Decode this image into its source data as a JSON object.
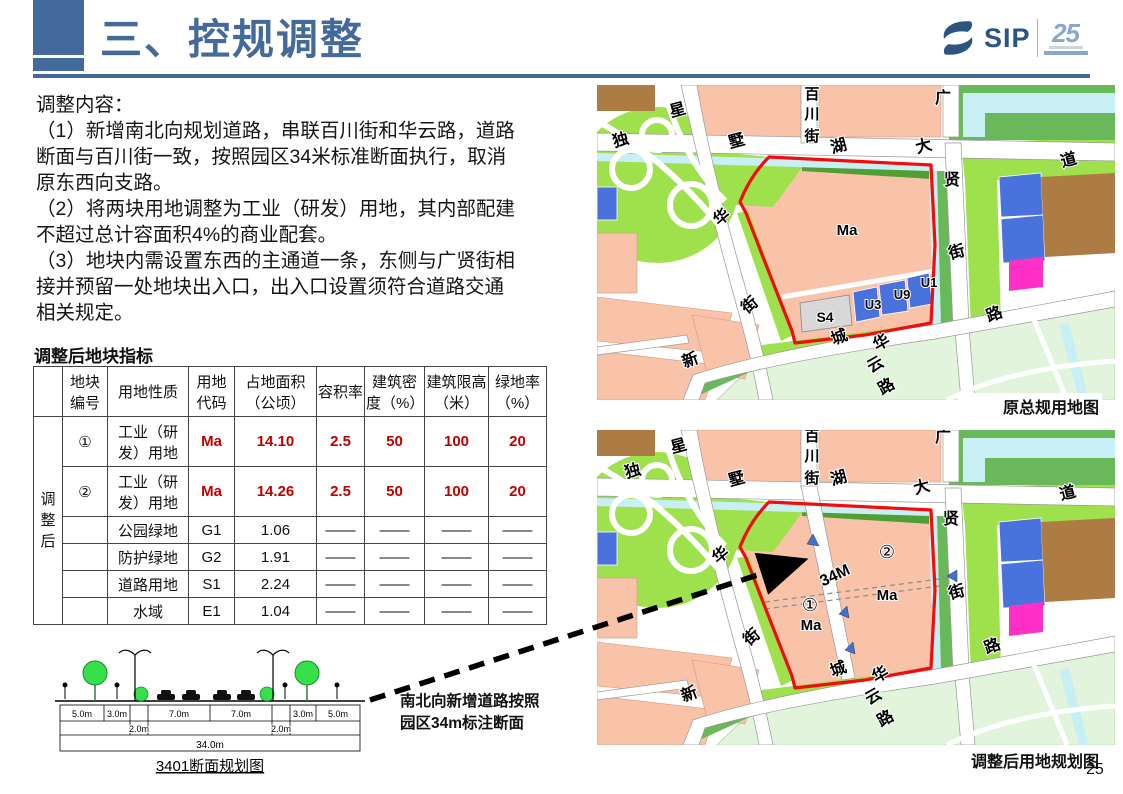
{
  "colors": {
    "accent": "#44699B",
    "table_red": "#C00000",
    "boundary_red": "#F20D0D",
    "salmon": "#F9C3AA",
    "bright_green": "#9FE14D",
    "mid_green": "#69B85A",
    "dark_green": "#4F9F35",
    "pale_green": "#E3F4DC",
    "water": "#C8F0F4",
    "parcel_blue": "#4A72DC",
    "magenta": "#FF2FC8",
    "brown": "#AC7C44",
    "gray_parcel": "#D8D8D8",
    "road_edge": "#999999"
  },
  "page": {
    "number": "25"
  },
  "header": {
    "title": "三、控规调整",
    "logo_text": "SIP",
    "logo_badge": "25"
  },
  "content": {
    "lines": [
      "调整内容：",
      "（1）新增南北向规划道路，串联百川街和华云路，道路",
      "断面与百川街一致，按照园区34米标准断面执行，取消",
      "原东西向支路。",
      "（2）将两块用地调整为工业（研发）用地，其内部配建",
      "不超过总计容面积4%的商业配套。",
      "（3）地块内需设置东西的主通道一条，东侧与广贤街相",
      "接并预留一处地块出入口，出入口设置须符合道路交通",
      "相关规定。"
    ]
  },
  "table": {
    "title": "调整后地块指标",
    "group_label": "调整后",
    "headers": [
      "",
      "地块编号",
      "用地性质",
      "用地代码",
      "占地面积（公顷）",
      "容积率",
      "建筑密度（%）",
      "建筑限高（米）",
      "绿地率（%）"
    ],
    "rows": [
      [
        "①",
        "工业（研发）用地",
        "Ma",
        "14.10",
        "2.5",
        "50",
        "100",
        "20"
      ],
      [
        "②",
        "工业（研发）用地",
        "Ma",
        "14.26",
        "2.5",
        "50",
        "100",
        "20"
      ],
      [
        "",
        "公园绿地",
        "G1",
        "1.06",
        "——",
        "——",
        "——",
        "——"
      ],
      [
        "",
        "防护绿地",
        "G2",
        "1.91",
        "——",
        "——",
        "——",
        "——"
      ],
      [
        "",
        "道路用地",
        "S1",
        "2.24",
        "——",
        "——",
        "——",
        "——"
      ],
      [
        "",
        "水域",
        "E1",
        "1.04",
        "——",
        "——",
        "——",
        "——"
      ]
    ]
  },
  "diagram": {
    "caption": "3401断面规划图",
    "labels": [
      {
        "t": "5.0m",
        "x": 37,
        "y": 74,
        "s": 9
      },
      {
        "t": "3.0m",
        "x": 72,
        "y": 74,
        "s": 9
      },
      {
        "t": "7.0m",
        "x": 134,
        "y": 74,
        "s": 9
      },
      {
        "t": "7.0m",
        "x": 196,
        "y": 74,
        "s": 9
      },
      {
        "t": "3.0m",
        "x": 258,
        "y": 74,
        "s": 9
      },
      {
        "t": "5.0m",
        "x": 293,
        "y": 74,
        "s": 9
      },
      {
        "t": "2.0m",
        "x": 94,
        "y": 89,
        "s": 9
      },
      {
        "t": "2.0m",
        "x": 236,
        "y": 89,
        "s": 9
      },
      {
        "t": "34.0m",
        "x": 165,
        "y": 105,
        "s": 10
      }
    ]
  },
  "arrow_note": {
    "lines": [
      "南北向新增道路按照",
      "园区34m标注断面"
    ]
  },
  "maps": {
    "top": {
      "caption": "原总规用地图",
      "labels": [
        {
          "t": "星",
          "x": 82,
          "y": 30,
          "s": 16,
          "b": 1,
          "r": -15
        },
        {
          "t": "独",
          "x": 25,
          "y": 60,
          "s": 16,
          "b": 1,
          "r": -15
        },
        {
          "t": "墅",
          "x": 141,
          "y": 61,
          "s": 16,
          "b": 1,
          "r": -15
        },
        {
          "t": "百",
          "x": 215,
          "y": 14,
          "s": 15,
          "b": 1
        },
        {
          "t": "川",
          "x": 215,
          "y": 34,
          "s": 15,
          "b": 1
        },
        {
          "t": "街",
          "x": 215,
          "y": 56,
          "s": 15,
          "b": 1
        },
        {
          "t": "湖",
          "x": 243,
          "y": 66,
          "s": 16,
          "b": 1,
          "r": -15
        },
        {
          "t": "大",
          "x": 328,
          "y": 66,
          "s": 16,
          "b": 1,
          "r": -15
        },
        {
          "t": "道",
          "x": 473,
          "y": 80,
          "s": 16,
          "b": 1,
          "r": -15
        },
        {
          "t": "广",
          "x": 346,
          "y": 18,
          "s": 16,
          "b": 1
        },
        {
          "t": "贤",
          "x": 355,
          "y": 100,
          "s": 16,
          "b": 1
        },
        {
          "t": "街",
          "x": 361,
          "y": 172,
          "s": 16,
          "b": 1,
          "r": -15
        },
        {
          "t": "Ma",
          "x": 250,
          "y": 150,
          "s": 15,
          "b": 1
        },
        {
          "t": "华",
          "x": 128,
          "y": 136,
          "s": 16,
          "b": 1,
          "r": -40
        },
        {
          "t": "街",
          "x": 156,
          "y": 224,
          "s": 16,
          "b": 1,
          "r": -40
        },
        {
          "t": "S4",
          "x": 228,
          "y": 237,
          "s": 14,
          "b": 1
        },
        {
          "t": "U3",
          "x": 276,
          "y": 224,
          "s": 13,
          "b": 1
        },
        {
          "t": "U9",
          "x": 305,
          "y": 214,
          "s": 13,
          "b": 1
        },
        {
          "t": "U1",
          "x": 332,
          "y": 202,
          "s": 13,
          "b": 1
        },
        {
          "t": "新",
          "x": 95,
          "y": 280,
          "s": 16,
          "b": 1,
          "r": -20
        },
        {
          "t": "城",
          "x": 244,
          "y": 257,
          "s": 16,
          "b": 1,
          "r": -20
        },
        {
          "t": "华",
          "x": 287,
          "y": 262,
          "s": 16,
          "b": 1,
          "r": -30
        },
        {
          "t": "云",
          "x": 281,
          "y": 284,
          "s": 16,
          "b": 1,
          "r": -30
        },
        {
          "t": "路",
          "x": 292,
          "y": 306,
          "s": 16,
          "b": 1,
          "r": -30
        },
        {
          "t": "路",
          "x": 399,
          "y": 234,
          "s": 16,
          "b": 1,
          "r": -20
        }
      ]
    },
    "bottom": {
      "caption": "调整后用地规划图",
      "labels": [
        {
          "t": "星",
          "x": 83,
          "y": 21,
          "s": 16,
          "b": 1,
          "r": -15
        },
        {
          "t": "独",
          "x": 37,
          "y": 46,
          "s": 16,
          "b": 1,
          "r": -15
        },
        {
          "t": "墅",
          "x": 141,
          "y": 54,
          "s": 16,
          "b": 1,
          "r": -15
        },
        {
          "t": "百",
          "x": 215,
          "y": 11,
          "s": 15,
          "b": 1
        },
        {
          "t": "川",
          "x": 215,
          "y": 31,
          "s": 15,
          "b": 1
        },
        {
          "t": "街",
          "x": 215,
          "y": 53,
          "s": 15,
          "b": 1
        },
        {
          "t": "湖",
          "x": 243,
          "y": 53,
          "s": 16,
          "b": 1,
          "r": -15
        },
        {
          "t": "大",
          "x": 326,
          "y": 62,
          "s": 16,
          "b": 1,
          "r": -15
        },
        {
          "t": "道",
          "x": 472,
          "y": 68,
          "s": 16,
          "b": 1,
          "r": -15
        },
        {
          "t": "广",
          "x": 346,
          "y": 12,
          "s": 16,
          "b": 1
        },
        {
          "t": "贤",
          "x": 354,
          "y": 94,
          "s": 16,
          "b": 1
        },
        {
          "t": "街",
          "x": 361,
          "y": 167,
          "s": 16,
          "b": 1,
          "r": -15
        },
        {
          "t": "华",
          "x": 127,
          "y": 129,
          "s": 16,
          "b": 1,
          "r": -40
        },
        {
          "t": "街",
          "x": 158,
          "y": 211,
          "s": 16,
          "b": 1,
          "r": -40
        },
        {
          "t": "新",
          "x": 94,
          "y": 269,
          "s": 16,
          "b": 1,
          "r": -20
        },
        {
          "t": "城",
          "x": 243,
          "y": 244,
          "s": 16,
          "b": 1,
          "r": -20
        },
        {
          "t": "华",
          "x": 286,
          "y": 249,
          "s": 16,
          "b": 1,
          "r": -30
        },
        {
          "t": "云",
          "x": 279,
          "y": 271,
          "s": 16,
          "b": 1,
          "r": -30
        },
        {
          "t": "路",
          "x": 291,
          "y": 293,
          "s": 16,
          "b": 1,
          "r": -30
        },
        {
          "t": "路",
          "x": 397,
          "y": 221,
          "s": 16,
          "b": 1,
          "r": -20
        },
        {
          "t": "②",
          "x": 290,
          "y": 128,
          "s": 18
        },
        {
          "t": "34M",
          "x": 240,
          "y": 150,
          "s": 16,
          "b": 1,
          "r": -25
        },
        {
          "t": "Ma",
          "x": 290,
          "y": 170,
          "s": 15,
          "b": 1
        },
        {
          "t": "①",
          "x": 213,
          "y": 181,
          "s": 18
        },
        {
          "t": "Ma",
          "x": 214,
          "y": 200,
          "s": 15,
          "b": 1
        }
      ]
    }
  }
}
